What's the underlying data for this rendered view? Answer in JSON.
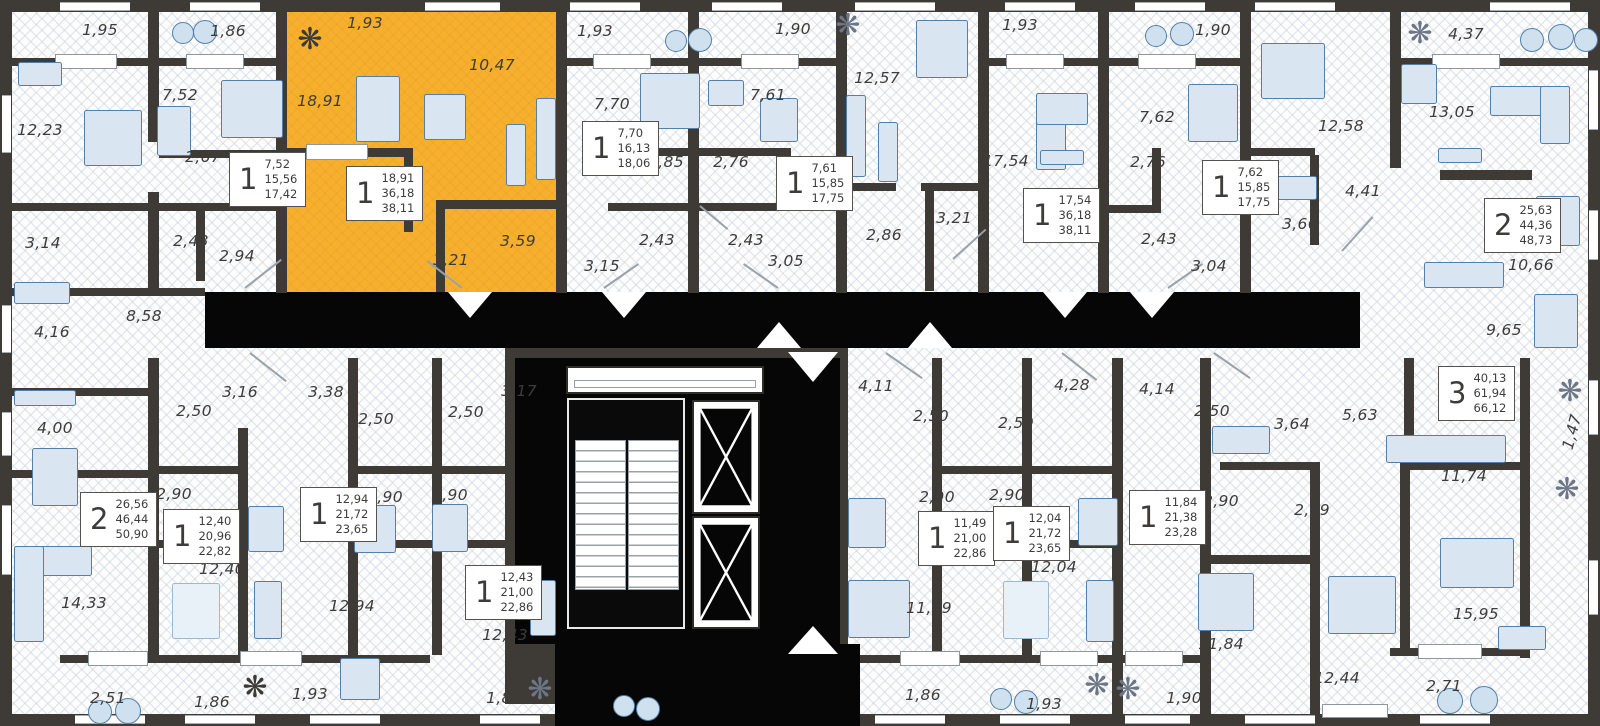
{
  "plan": {
    "type": "residential-floor-plan",
    "highlight_color": "#F7B02E",
    "wall_color": "#3E3A36",
    "furniture_color": "#D9E6F2",
    "furniture_stroke": "#5480A8",
    "label_color": "#3E3C3A"
  },
  "selected_unit": {
    "rooms": "1",
    "living_area": "18,91",
    "area": "36,18",
    "total_area": "38,11"
  },
  "labels": [
    {
      "t": "1,95",
      "x": 100,
      "y": 30
    },
    {
      "t": "1,86",
      "x": 228,
      "y": 31
    },
    {
      "t": "1,93",
      "x": 365,
      "y": 23
    },
    {
      "t": "10,47",
      "x": 492,
      "y": 65
    },
    {
      "t": "1,93",
      "x": 595,
      "y": 31
    },
    {
      "t": "1,90",
      "x": 793,
      "y": 29
    },
    {
      "t": "1,93",
      "x": 1020,
      "y": 25
    },
    {
      "t": "1,90",
      "x": 1213,
      "y": 30
    },
    {
      "t": "4,37",
      "x": 1466,
      "y": 34
    },
    {
      "t": "12,23",
      "x": 40,
      "y": 130
    },
    {
      "t": "7,52",
      "x": 180,
      "y": 95
    },
    {
      "t": "18,91",
      "x": 320,
      "y": 101
    },
    {
      "t": "2,67",
      "x": 203,
      "y": 157
    },
    {
      "t": "7,70",
      "x": 612,
      "y": 104
    },
    {
      "t": "7,61",
      "x": 768,
      "y": 95
    },
    {
      "t": "12,57",
      "x": 877,
      "y": 78
    },
    {
      "t": "17,54",
      "x": 1006,
      "y": 161
    },
    {
      "t": "7,62",
      "x": 1157,
      "y": 117
    },
    {
      "t": "12,58",
      "x": 1341,
      "y": 126
    },
    {
      "t": "13,05",
      "x": 1452,
      "y": 112
    },
    {
      "t": "2,85",
      "x": 666,
      "y": 162
    },
    {
      "t": "2,76",
      "x": 731,
      "y": 162
    },
    {
      "t": "2,76",
      "x": 1148,
      "y": 162
    },
    {
      "t": "3,66",
      "x": 1300,
      "y": 224
    },
    {
      "t": "4,41",
      "x": 1363,
      "y": 191
    },
    {
      "t": "3,14",
      "x": 43,
      "y": 243
    },
    {
      "t": "2,43",
      "x": 191,
      "y": 241
    },
    {
      "t": "2,94",
      "x": 237,
      "y": 256
    },
    {
      "t": "3,21",
      "x": 451,
      "y": 260
    },
    {
      "t": "3,59",
      "x": 518,
      "y": 241
    },
    {
      "t": "2,43",
      "x": 657,
      "y": 240
    },
    {
      "t": "2,43",
      "x": 746,
      "y": 240
    },
    {
      "t": "3,15",
      "x": 602,
      "y": 266
    },
    {
      "t": "3,05",
      "x": 786,
      "y": 261
    },
    {
      "t": "2,86",
      "x": 884,
      "y": 235
    },
    {
      "t": "3,21",
      "x": 954,
      "y": 218
    },
    {
      "t": "2,43",
      "x": 1159,
      "y": 239
    },
    {
      "t": "3,04",
      "x": 1209,
      "y": 266
    },
    {
      "t": "10,66",
      "x": 1531,
      "y": 265
    },
    {
      "t": "8,58",
      "x": 144,
      "y": 316
    },
    {
      "t": "4,16",
      "x": 52,
      "y": 332
    },
    {
      "t": "4,00",
      "x": 55,
      "y": 428
    },
    {
      "t": "3,16",
      "x": 240,
      "y": 392
    },
    {
      "t": "3,38",
      "x": 326,
      "y": 392
    },
    {
      "t": "3,17",
      "x": 519,
      "y": 391
    },
    {
      "t": "2,50",
      "x": 194,
      "y": 411
    },
    {
      "t": "2,50",
      "x": 376,
      "y": 419
    },
    {
      "t": "2,50",
      "x": 466,
      "y": 412
    },
    {
      "t": "2,90",
      "x": 174,
      "y": 494
    },
    {
      "t": "2,90",
      "x": 385,
      "y": 497
    },
    {
      "t": "2,90",
      "x": 450,
      "y": 495
    },
    {
      "t": "4,11",
      "x": 876,
      "y": 386
    },
    {
      "t": "4,28",
      "x": 1072,
      "y": 385
    },
    {
      "t": "4,14",
      "x": 1157,
      "y": 389
    },
    {
      "t": "2,50",
      "x": 931,
      "y": 416
    },
    {
      "t": "2,50",
      "x": 1016,
      "y": 423
    },
    {
      "t": "2,50",
      "x": 1212,
      "y": 411
    },
    {
      "t": "2,90",
      "x": 937,
      "y": 497
    },
    {
      "t": "2,90",
      "x": 1007,
      "y": 495
    },
    {
      "t": "2,90",
      "x": 1221,
      "y": 501
    },
    {
      "t": "3,64",
      "x": 1292,
      "y": 424
    },
    {
      "t": "5,63",
      "x": 1360,
      "y": 415
    },
    {
      "t": "9,65",
      "x": 1504,
      "y": 330
    },
    {
      "t": "11,74",
      "x": 1464,
      "y": 476
    },
    {
      "t": "1,47",
      "x": 1572,
      "y": 432,
      "r": -75
    },
    {
      "t": "2,89",
      "x": 1312,
      "y": 510
    },
    {
      "t": "14,33",
      "x": 84,
      "y": 603
    },
    {
      "t": "12,40",
      "x": 222,
      "y": 569
    },
    {
      "t": "12,94",
      "x": 352,
      "y": 606
    },
    {
      "t": "12,43",
      "x": 505,
      "y": 635
    },
    {
      "t": "11,49",
      "x": 929,
      "y": 608
    },
    {
      "t": "12,04",
      "x": 1054,
      "y": 567
    },
    {
      "t": "11,84",
      "x": 1221,
      "y": 644
    },
    {
      "t": "12,44",
      "x": 1337,
      "y": 678
    },
    {
      "t": "15,95",
      "x": 1476,
      "y": 614
    },
    {
      "t": "2,71",
      "x": 1444,
      "y": 686
    },
    {
      "t": "2,51",
      "x": 108,
      "y": 698
    },
    {
      "t": "1,86",
      "x": 212,
      "y": 702
    },
    {
      "t": "1,93",
      "x": 310,
      "y": 694
    },
    {
      "t": "1,86",
      "x": 504,
      "y": 698
    },
    {
      "t": "1,86",
      "x": 923,
      "y": 695
    },
    {
      "t": "1,93",
      "x": 1044,
      "y": 704
    },
    {
      "t": "1,90",
      "x": 1184,
      "y": 698
    }
  ],
  "units": [
    {
      "n": "1",
      "areas": [
        "7,52",
        "15,56",
        "17,42"
      ],
      "x": 229,
      "y": 152
    },
    {
      "n": "1",
      "areas": [
        "18,91",
        "36,18",
        "38,11"
      ],
      "x": 346,
      "y": 166
    },
    {
      "n": "1",
      "areas": [
        "7,70",
        "16,13",
        "18,06"
      ],
      "x": 582,
      "y": 121
    },
    {
      "n": "1",
      "areas": [
        "7,61",
        "15,85",
        "17,75"
      ],
      "x": 776,
      "y": 156
    },
    {
      "n": "1",
      "areas": [
        "17,54",
        "36,18",
        "38,11"
      ],
      "x": 1023,
      "y": 188
    },
    {
      "n": "1",
      "areas": [
        "7,62",
        "15,85",
        "17,75"
      ],
      "x": 1202,
      "y": 160
    },
    {
      "n": "2",
      "areas": [
        "25,63",
        "44,36",
        "48,73"
      ],
      "x": 1484,
      "y": 198
    },
    {
      "n": "3",
      "areas": [
        "40,13",
        "61,94",
        "66,12"
      ],
      "x": 1438,
      "y": 366
    },
    {
      "n": "2",
      "areas": [
        "26,56",
        "46,44",
        "50,90"
      ],
      "x": 80,
      "y": 492
    },
    {
      "n": "1",
      "areas": [
        "12,40",
        "20,96",
        "22,82"
      ],
      "x": 163,
      "y": 509
    },
    {
      "n": "1",
      "areas": [
        "12,94",
        "21,72",
        "23,65"
      ],
      "x": 300,
      "y": 487
    },
    {
      "n": "1",
      "areas": [
        "12,43",
        "21,00",
        "22,86"
      ],
      "x": 465,
      "y": 565
    },
    {
      "n": "1",
      "areas": [
        "11,49",
        "21,00",
        "22,86"
      ],
      "x": 918,
      "y": 511
    },
    {
      "n": "1",
      "areas": [
        "12,04",
        "21,72",
        "23,65"
      ],
      "x": 993,
      "y": 506
    },
    {
      "n": "1",
      "areas": [
        "11,84",
        "21,38",
        "23,28"
      ],
      "x": 1129,
      "y": 490
    }
  ]
}
